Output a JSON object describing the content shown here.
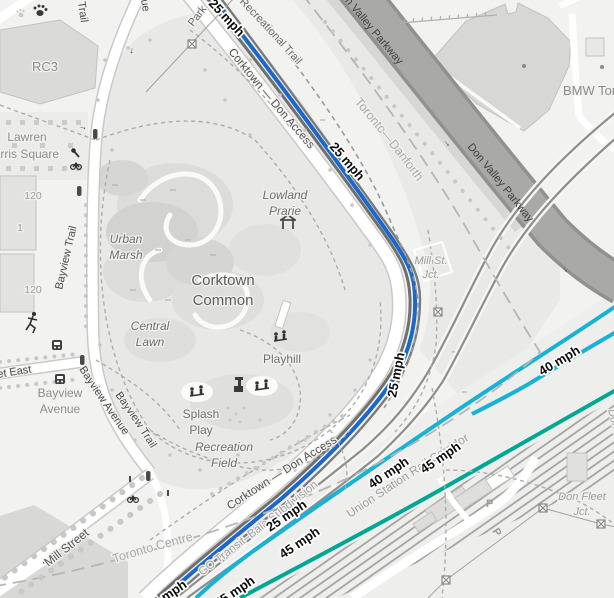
{
  "map": {
    "labels": {
      "trail_partial": "Trail",
      "avenue_partial": "ue",
      "park_partial": "Park",
      "rc3": "RC3",
      "lawren_line1": "Lawren",
      "lawren_line2": "Harris Square",
      "addr_120_a": "120",
      "addr_1": "1",
      "addr_120_b": "120",
      "bayview_trail_n": "Bayview Trail",
      "bayview_trail_s": "Bayview Trail",
      "urban_marsh_1": "Urban",
      "urban_marsh_2": "Marsh",
      "corktown_common_1": "Corktown",
      "corktown_common_2": "Common",
      "lowland_1": "Lowland",
      "lowland_2": "Prarie",
      "central_1": "Central",
      "central_2": "Lawn",
      "playhill": "Playhill",
      "splash_1": "Splash",
      "splash_2": "Play",
      "rec_field_1": "Recreation",
      "rec_field_2": "Field",
      "bayview_ave_place_1": "Bayview",
      "bayview_ave_place_2": "Avenue",
      "bayview_ave_road": "Bayview Avenue",
      "street_east": "Street East",
      "mill_street": "Mill Street",
      "toronto_centre": "Toronto Centre",
      "corktown_access_n": "Corktown — Don Access",
      "corktown_access_s": "Corktown — Don Access",
      "recreational_trail": "Recreational Trail",
      "toronto_danforth": "Toronto—Danforth",
      "dvp_n": "Don Valley Parkway",
      "dvp_s": "Don Valley Parkway",
      "bmw": "BMW Toronto",
      "mill_jct_1": "Mill St.",
      "mill_jct_2": "Jct.",
      "don_fleet_1": "Don Fleet",
      "don_fleet_2": "Jct.",
      "don_river": "Don River",
      "go_bala": "GO Transit–Bala Subdivision",
      "uscr": "Union Station Rail Corridor",
      "one_way_arrow": "→"
    },
    "speed_labels": {
      "s25": "25 mph",
      "s40": "40 mph",
      "s45": "45 mph"
    },
    "parking_label": "P",
    "colors": {
      "speed_25_mph": "#1a67cd",
      "speed_40_mph": "#16b3d6",
      "speed_45_mph": "#00a893",
      "railway": "#6f6f6d",
      "railway_light": "#8e8e8c",
      "motorway_fill": "#a9a9a7",
      "background": "#f2f2f0"
    }
  }
}
